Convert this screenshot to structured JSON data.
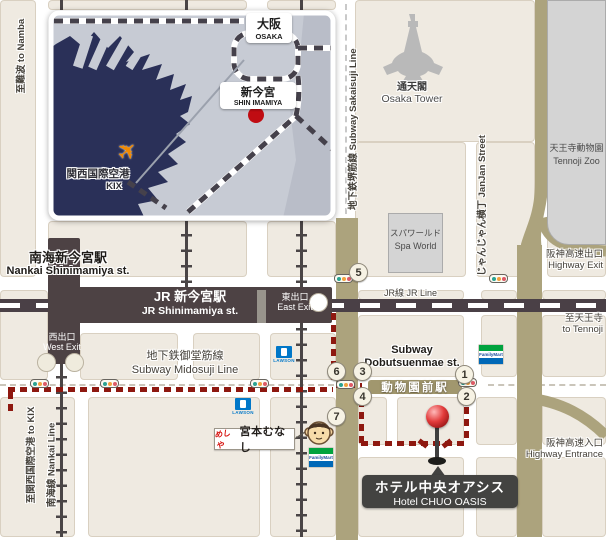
{
  "inset_map": {
    "osaka": {
      "jp": "大阪",
      "en": "OSAKA"
    },
    "shin_imamiya": {
      "jp": "新今宮",
      "en": "SHIN IMAMIYA"
    },
    "kansai_airport": {
      "jp": "関西国際空港",
      "en": "KIX"
    }
  },
  "edge_labels": {
    "to_namba": "至難波 to Namba",
    "to_kix": "至関西国際空港 to KIX",
    "nankai_line": "南海線 Nankai Line",
    "to_tennoji_jp": "至天王寺",
    "to_tennoji_en": "to Tennoji"
  },
  "lines": {
    "sakaisuji": "地下鉄堺筋線  Subway Sakaisuji Line",
    "midosuji_jp": "地下鉄御堂筋線",
    "midosuji_en": "Subway Midosuji Line",
    "jr_line": "JR線 JR Line",
    "janjan": "じゃんじゃん横丁  JanJan Street"
  },
  "stations": {
    "nankai_jp": "南海新今宮駅",
    "nankai_en": "Nankai Shinimamiya st.",
    "jr_jp": "JR 新今宮駅",
    "jr_en": "JR Shinimamiya st.",
    "east_exit_jp": "東出口",
    "east_exit_en": "East Exit",
    "west_exit_jp": "西出口",
    "west_exit_en": "West Exit",
    "dobutsuenmae_en1": "Subway",
    "dobutsuenmae_en2": "Dobutsuenmae st.",
    "dobutsuenmae_jp": "動物園前駅"
  },
  "landmarks": {
    "tower_jp": "通天閣",
    "tower_en": "Osaka Tower",
    "zoo_jp": "天王寺動物園",
    "zoo_en": "Tennoji Zoo",
    "spa_jp": "スパワールド",
    "spa_en": "Spa World",
    "hwy_exit_jp": "阪神高速出口",
    "hwy_exit_en": "Highway Exit",
    "hwy_ent_jp": "阪神高速入口",
    "hwy_ent_en": "Highway Entrance",
    "munashi_logo": "めしや",
    "munashi": "宮本むなし",
    "lawson": "LAWSON",
    "familymart": "FamilyMart"
  },
  "hotel": {
    "jp": "ホテル中央オアシス",
    "en": "Hotel CHUO OASIS"
  },
  "exit_numbers": [
    "1",
    "2",
    "3",
    "4",
    "5",
    "6",
    "7"
  ],
  "colors": {
    "route": "#8E1810",
    "tan_road": "#ACA37D",
    "station_dark": "#4D4244",
    "water": "#2A3058",
    "marker_red": "#C00C12"
  }
}
